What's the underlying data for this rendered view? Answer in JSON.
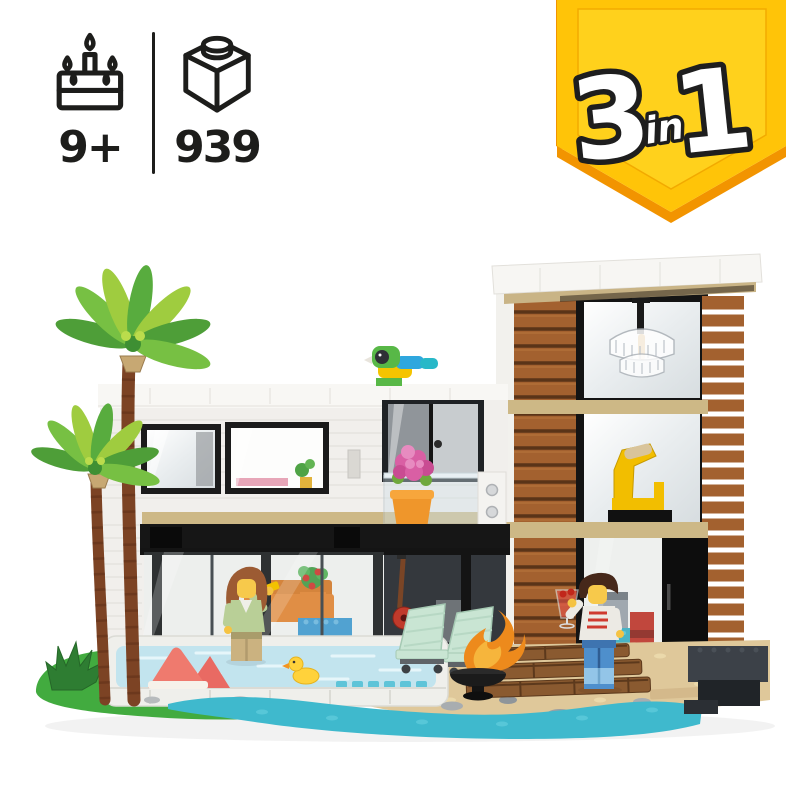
{
  "page": {
    "background": "#ffffff"
  },
  "header_badges": {
    "text_color": "#1d1d1b",
    "age": {
      "icon": "cake-icon",
      "value": "9+"
    },
    "piece_count": {
      "icon": "brick-icon",
      "value": "939"
    }
  },
  "banner_3in1": {
    "big_left": "3",
    "small_mid": "in",
    "big_right": "1",
    "fill": "#FFC408",
    "fill_light": "#FFD21E",
    "edge": "#F29400",
    "text_fill": "#FFFFFF",
    "text_outline": "#1E1E1E"
  },
  "scene": {
    "name": "lego-modern-house-photo",
    "elements": [
      "modern-house",
      "glass-tower",
      "palm-trees",
      "swimming-pool",
      "rubber-duck",
      "watermelon-decoration",
      "parrot",
      "balcony-flowers",
      "chandelier",
      "yellow-armchair",
      "lounge-chairs",
      "fire-pit",
      "wooden-steps",
      "female-minifigure",
      "male-minifigure",
      "coffee-bar",
      "beach-water",
      "grass-base",
      "agave-plant"
    ],
    "colors": {
      "wood": "#A3612F",
      "wall_white": "#F1EFEC",
      "frame_black": "#161616",
      "tan_band": "#CDB886",
      "grass": "#42AB3F",
      "sand": "#DFC89A",
      "water": "#3FB9CD",
      "pool_water": "#C2E4EE",
      "leaf_green": "#58AC3E",
      "leaf_lime": "#9FCC3F",
      "trunk_brown": "#7C4324",
      "mint_chair": "#C9E5D3",
      "flame_orange": "#ED8A1C"
    }
  }
}
